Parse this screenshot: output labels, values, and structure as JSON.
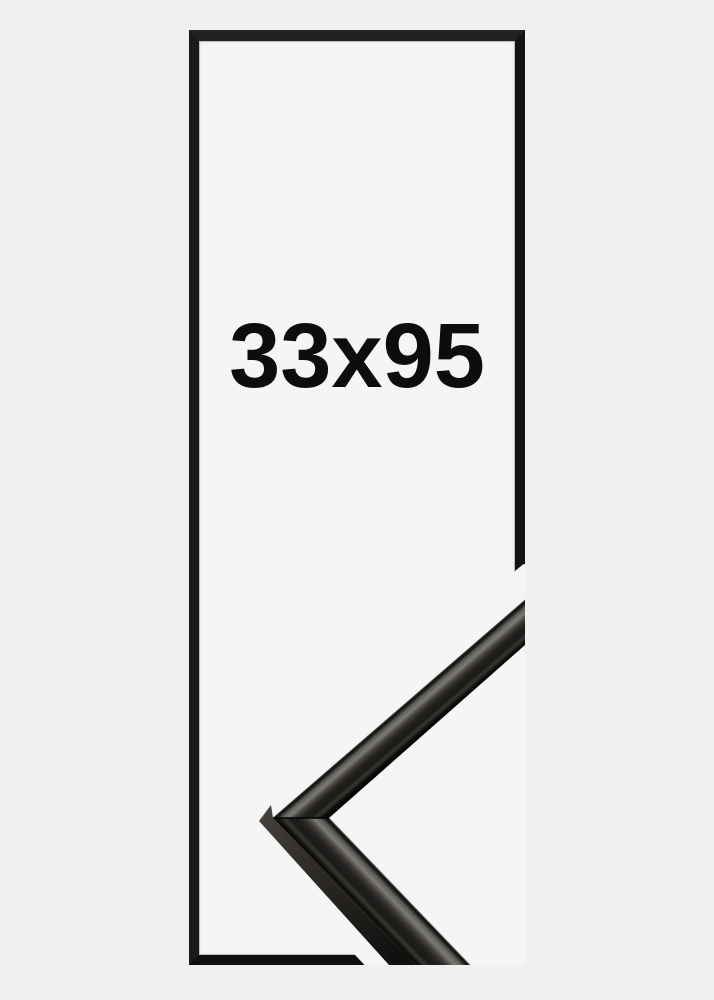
{
  "product": {
    "size_label": "33x95"
  },
  "frame_preview": {
    "shape": "tall-rectangle-outline",
    "corner_detail": "black-metal-moulding-corner-sample"
  },
  "colors": {
    "page_background": "#f0f0f1",
    "frame_interior": "#f5f5f6",
    "frame_border": "#151515",
    "label_text": "#0d0d0d",
    "moulding_dark": "#0b0a09",
    "moulding_sheen": "#7d7b75"
  }
}
